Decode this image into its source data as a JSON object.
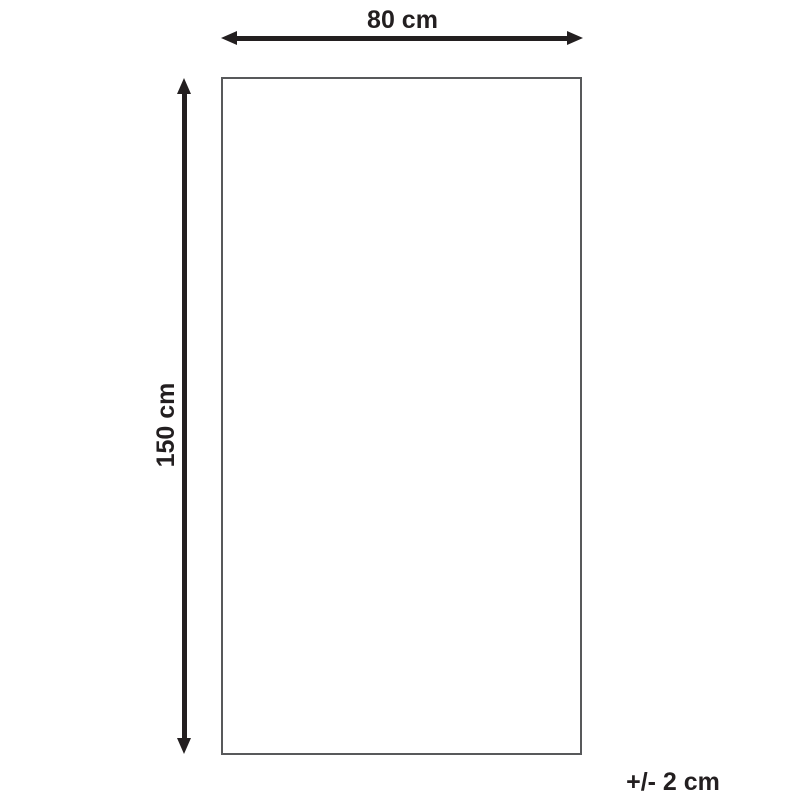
{
  "diagram": {
    "title": "product-dimension-diagram",
    "width_label": "80 cm",
    "height_label": "150 cm",
    "tolerance_label": "+/- 2 cm"
  },
  "colors": {
    "arrow": "#231f20",
    "outline": "#58595b",
    "background": "#ffffff"
  }
}
